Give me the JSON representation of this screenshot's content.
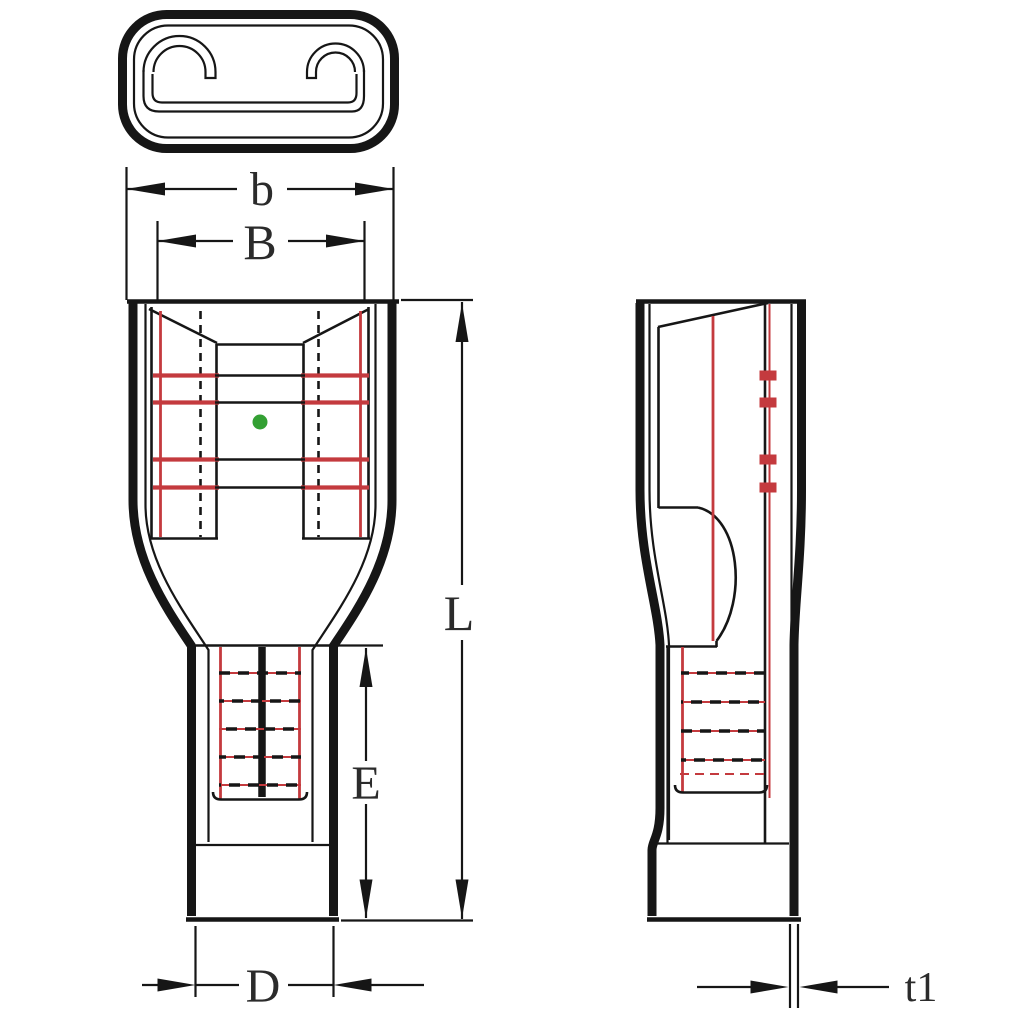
{
  "labels": {
    "b": "b",
    "B": "B",
    "L": "L",
    "E": "E",
    "D": "D",
    "t1": "t1"
  },
  "colors": {
    "outline": "#161616",
    "crimp-red": "#c43a3e",
    "indicator-green": "#33a033",
    "dim-text": "#2b2b2b",
    "background": "#ffffff"
  }
}
